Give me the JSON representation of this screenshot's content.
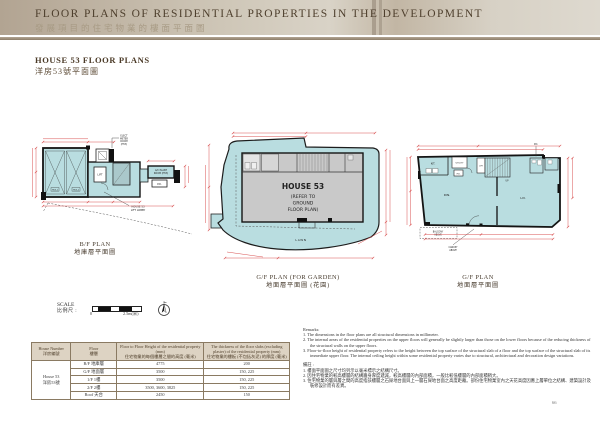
{
  "header": {
    "title_en": "FLOOR PLANS OF RESIDENTIAL PROPERTIES IN THE DEVELOPMENT",
    "title_zh": "發展項目的住宅物業的樓面平面圖"
  },
  "section": {
    "title_en": "HOUSE 53 FLOOR PLANS",
    "title_zh": "洋房53號平面圖"
  },
  "plans": {
    "bf": {
      "caption_en": "B/F PLAN",
      "caption_zh": "地庫層平面圖",
      "labels": {
        "elect_1": "ELECT",
        "elect_2": "METER",
        "elect_3": "ROOM",
        "elect_4": "(H53)",
        "lift": "LIFT",
        "carpark_1": "H53-1",
        "carpark_2": "H53-2",
        "ac_1": "A/C PLANT",
        "ac_2": "ROOM (H53)",
        "pd": "P.D.",
        "lobby_1": "HOUSE 53",
        "lobby_2": "LIFT LOBBY"
      }
    },
    "gf_garden": {
      "caption_en": "G/F PLAN (FOR GARDEN)",
      "caption_zh": "地面層平面圖 (花園)",
      "labels": {
        "house": "HOUSE 53",
        "refer_1": "(REFER TO",
        "refer_2": "GROUND",
        "refer_3": "FLOOR PLAN)",
        "lawn": "LAWN"
      }
    },
    "gf": {
      "caption_en": "G/F PLAN",
      "caption_zh": "地面層平面圖",
      "labels": {
        "kit": "KIT.",
        "utility": "UTILITY",
        "pd_top": "P.D.",
        "pd": "P.D.",
        "lift": "LIFT",
        "up": "UP",
        "din": "DIN.",
        "liv": "LIV.",
        "balcony_1": "BALCONY",
        "balcony_2": "ABOVE",
        "canopy_1": "CANOPY",
        "canopy_2": "ABOVE"
      }
    }
  },
  "scale": {
    "label_en": "SCALE",
    "label_zh": "比例尺 :",
    "zero": "0",
    "max": "2.5m(米)"
  },
  "table": {
    "headers": {
      "house_en": "House Number",
      "house_zh": "洋房編號",
      "floor_en": "Floor",
      "floor_zh": "樓層",
      "height_en": "Floor to Floor Height of the residential property (mm)",
      "height_zh": "住宅物業的每個樓層之間的高度 (毫米)",
      "thickness_en": "The thickness of the floor slabs (excluding plaster) of the residential property (mm)",
      "thickness_zh": "住宅物業的樓板 (不包括灰泥) 的厚度 (毫米)"
    },
    "house_en": "House 53",
    "house_zh": "洋房53號",
    "rows": [
      {
        "floor": "B/F 地庫層",
        "height": "4775",
        "thickness": "200"
      },
      {
        "floor": "G/F 地面層",
        "height": "3500",
        "thickness": "150, 225"
      },
      {
        "floor": "1/F 1樓",
        "height": "3500",
        "thickness": "150, 225"
      },
      {
        "floor": "2/F 2樓",
        "height": "3500, 3600, 3825",
        "thickness": "150, 225"
      },
      {
        "floor": "Roof 天台",
        "height": "2450",
        "thickness": "150"
      }
    ]
  },
  "remarks": {
    "title_en": "Remarks:",
    "en": [
      "1. The dimensions in the floor plans are all structural dimensions in millimeter.",
      "2. The internal areas of the residential properties on the upper floors will generally be slightly larger than those on the lower floors because of the reducing thickness of the structural walls on the upper floors.",
      "3. Floor-to-floor height of residential property refers to the height between the top surface of the structural slab of a floor and the top surface of the structural slab of its immediate upper floor. The internal ceiling height within some residential property varies due to structural, architectural and decoration design variations."
    ],
    "title_zh": "備註 :",
    "zh": [
      "1. 樓面平面圖之尺寸均列示以毫米標示之結構尺寸。",
      "2. 因住宅物業的較高樓層的結構牆身厚度遞減，較高樓層的內部面積，一般比較低樓層的內部面積稍大。",
      "3. 住宅物業的層與層之間的高度指該樓層之石屎地台面與上一層石屎地台面之高度距離。部份住宅物業室內之天花高度因應上層單位之結構、建築設計及裝修設計而有差異。"
    ]
  },
  "footer": {
    "page_number": "66"
  }
}
